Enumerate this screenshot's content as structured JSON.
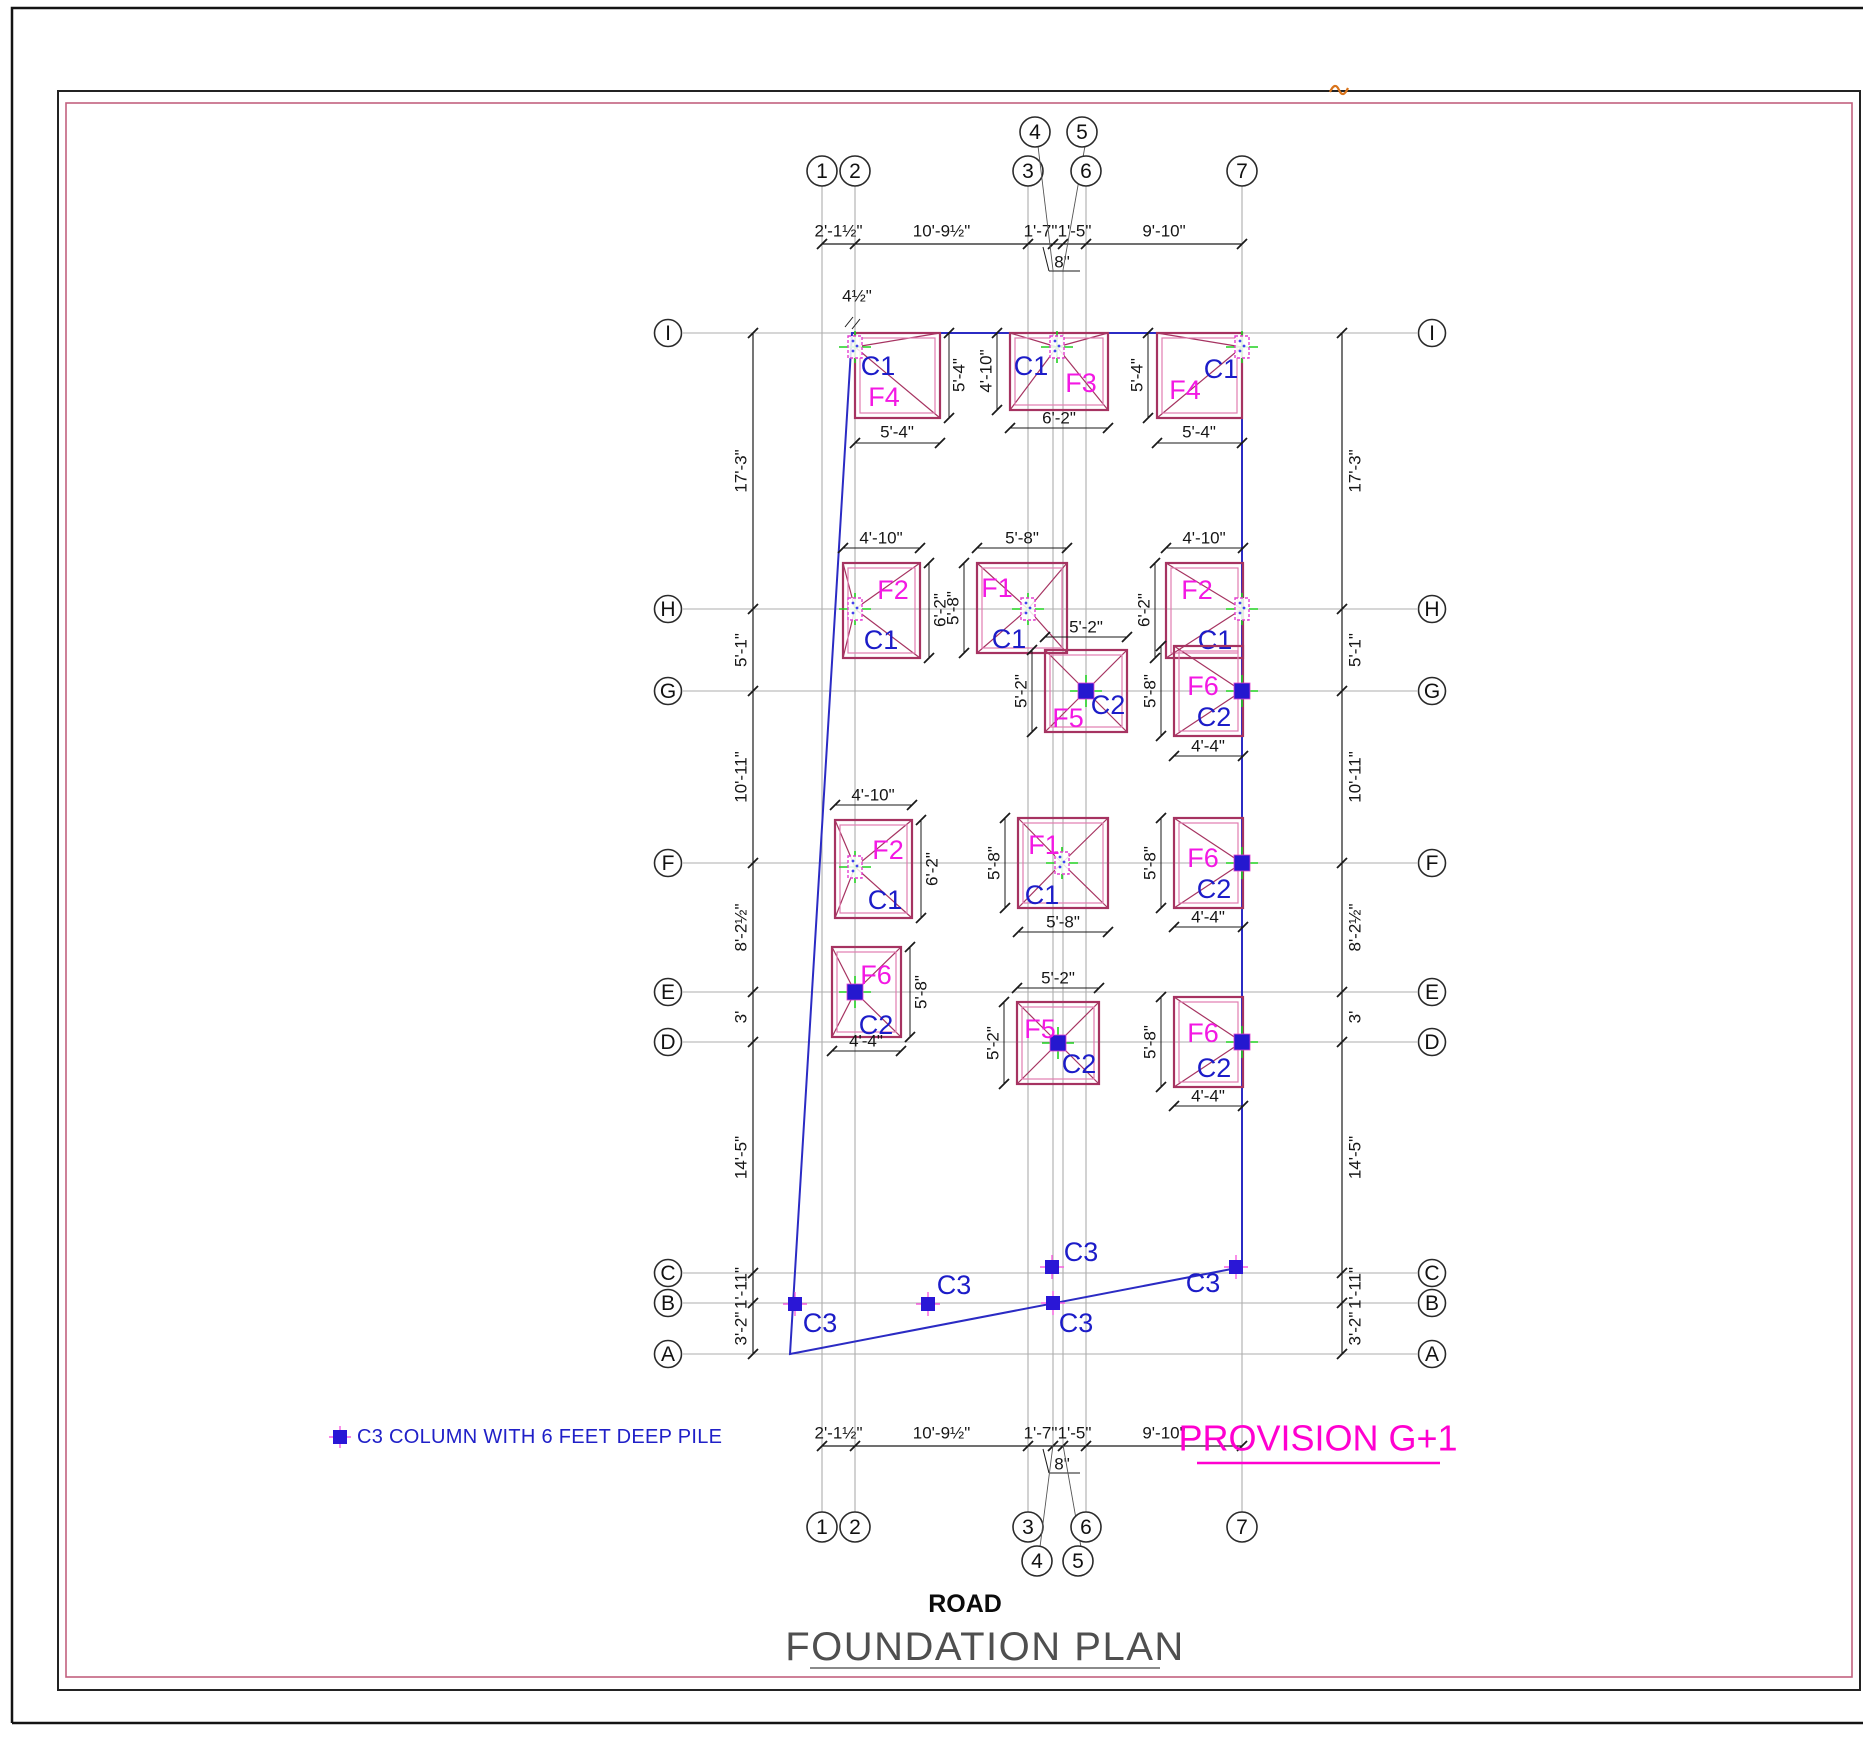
{
  "page": {
    "title_road": "ROAD",
    "title_plan": "FOUNDATION PLAN",
    "provision": "PROVISION G+1",
    "legend_text": "C3 COLUMN WITH 6 FEET DEEP PILE"
  },
  "colors": {
    "footing": "#A63361",
    "footing_inner": "#E17DB0",
    "grid": "#ADADAD",
    "dim": "#1A1A1A",
    "building_blue": "#2B2BC4",
    "label_c_blue": "#1C1CC8",
    "label_f_magenta": "#F318E3",
    "provision_magenta": "#FF00D0",
    "legend_blue": "#2020C8",
    "green_cross": "#21D121",
    "c2_fill": "#2518CF",
    "c3_fill": "#2A17D6",
    "c3_cross": "#F85FE0",
    "frame_pink": "#C2607E",
    "title_gray": "#4F4F4F",
    "orange": "#D9731A",
    "bubble_stroke": "#2A2A2A"
  },
  "grid": {
    "cols": [
      {
        "id": "1",
        "x": 822
      },
      {
        "id": "2",
        "x": 855
      },
      {
        "id": "3",
        "x": 1028
      },
      {
        "id": "4",
        "x": 1053,
        "short": true,
        "bt": [
          1035,
          132
        ],
        "bb": [
          1037,
          1561
        ]
      },
      {
        "id": "5",
        "x": 1063,
        "short": true,
        "bt": [
          1082,
          132
        ],
        "bb": [
          1078,
          1561
        ]
      },
      {
        "id": "6",
        "x": 1086
      },
      {
        "id": "7",
        "x": 1242
      }
    ],
    "rows": [
      {
        "id": "I",
        "y": 333
      },
      {
        "id": "H",
        "y": 609
      },
      {
        "id": "G",
        "y": 691
      },
      {
        "id": "F",
        "y": 863
      },
      {
        "id": "E",
        "y": 992
      },
      {
        "id": "D",
        "y": 1042
      },
      {
        "id": "C",
        "y": 1273
      },
      {
        "id": "B",
        "y": 1303
      },
      {
        "id": "A",
        "y": 1354
      }
    ],
    "col_line_y": [
      185,
      1512
    ],
    "col_line_y_short": [
      270,
      1445
    ],
    "row_line_x": [
      683,
      1417
    ],
    "top_bubble_y": 171,
    "bottom_bubble_y": 1527,
    "left_bubble_x": 668,
    "right_bubble_x": 1432
  },
  "dim_chains": [
    {
      "type": "v",
      "x": 753,
      "pts": [
        333,
        609,
        691,
        863,
        992,
        1042,
        1273,
        1303,
        1354
      ],
      "labels": [
        "17'-3\"",
        "5'-1\"",
        "10'-11\"",
        "8'-2½\"",
        "3'",
        "14'-5\"",
        "1'-11\"",
        "3'-2\""
      ],
      "side": -12
    },
    {
      "type": "v",
      "x": 1342,
      "pts": [
        333,
        609,
        691,
        863,
        992,
        1042,
        1273,
        1303,
        1354
      ],
      "labels": [
        "17'-3\"",
        "5'-1\"",
        "10'-11\"",
        "8'-2½\"",
        "3'",
        "14'-5\"",
        "1'-11\"",
        "3'-2\""
      ],
      "side": 13
    },
    {
      "type": "h",
      "y": 244,
      "pts": [
        822,
        855,
        1028,
        1053,
        1063,
        1086,
        1242
      ],
      "labels": [
        "2'-1½\"",
        "10'-9½\"",
        "1'-7\"",
        "",
        "1'-5\"",
        "9'-10\""
      ],
      "side": -13
    },
    {
      "type": "h",
      "y": 1446,
      "pts": [
        822,
        855,
        1028,
        1053,
        1063,
        1086,
        1242
      ],
      "labels": [
        "2'-1½\"",
        "10'-9½\"",
        "1'-7\"",
        "",
        "1'-5\"",
        "9'-10\""
      ],
      "side": -13
    }
  ],
  "annotations": [
    {
      "t": "8\"",
      "x": 1062,
      "y": 262,
      "lines": [
        [
          1043,
          247,
          1049,
          271
        ],
        [
          1049,
          271,
          1080,
          271
        ]
      ]
    },
    {
      "t": "8\"",
      "x": 1062,
      "y": 1464,
      "lines": [
        [
          1043,
          1449,
          1049,
          1473
        ],
        [
          1049,
          1473,
          1080,
          1473
        ]
      ]
    },
    {
      "t": "4½\"",
      "x": 857,
      "y": 296,
      "lines": [
        [
          845,
          327,
          853,
          317
        ],
        [
          852,
          329,
          860,
          319
        ]
      ]
    }
  ],
  "building_outline": [
    [
      852,
      333
    ],
    [
      1242,
      333
    ],
    [
      1242,
      1267
    ],
    [
      790,
      1354
    ]
  ],
  "footings": [
    {
      "n": "F4",
      "c": "C1",
      "r": [
        855,
        333,
        85,
        85
      ],
      "col": [
        855,
        347
      ],
      "ct": "C1",
      "fl": [
        884,
        397
      ],
      "cl": [
        878,
        366
      ],
      "dims": [
        {
          "x1": 949,
          "y1": 333,
          "x2": 949,
          "y2": 418,
          "t": "5'-4\"",
          "tx": 959,
          "ty": 375,
          "rot": 1
        },
        {
          "x1": 855,
          "y1": 443,
          "x2": 940,
          "y2": 443,
          "t": "5'-4\"",
          "tx": 897,
          "ty": 432,
          "rot": 0
        }
      ]
    },
    {
      "n": "F3",
      "c": "C1",
      "r": [
        1010,
        333,
        98,
        77
      ],
      "col": [
        1057,
        347
      ],
      "ct": "C1",
      "fl": [
        1081,
        383
      ],
      "cl": [
        1031,
        366
      ],
      "dims": [
        {
          "x1": 997,
          "y1": 333,
          "x2": 997,
          "y2": 410,
          "t": "4'-10\"",
          "tx": 986,
          "ty": 371,
          "rot": 1
        },
        {
          "x1": 1010,
          "y1": 428,
          "x2": 1108,
          "y2": 428,
          "t": "6'-2\"",
          "tx": 1059,
          "ty": 418,
          "rot": 0
        }
      ]
    },
    {
      "n": "F4",
      "c": "C1",
      "r": [
        1157,
        333,
        85,
        85
      ],
      "col": [
        1242,
        347
      ],
      "ct": "C1",
      "fl": [
        1185,
        390
      ],
      "cl": [
        1221,
        369
      ],
      "dims": [
        {
          "x1": 1148,
          "y1": 333,
          "x2": 1148,
          "y2": 418,
          "t": "5'-4\"",
          "tx": 1137,
          "ty": 375,
          "rot": 1
        },
        {
          "x1": 1157,
          "y1": 443,
          "x2": 1242,
          "y2": 443,
          "t": "5'-4\"",
          "tx": 1199,
          "ty": 432,
          "rot": 0
        }
      ]
    },
    {
      "n": "F2",
      "c": "C1",
      "r": [
        843,
        563,
        77,
        95
      ],
      "col": [
        855,
        609
      ],
      "ct": "C1",
      "fl": [
        893,
        590
      ],
      "cl": [
        881,
        640
      ],
      "dims": [
        {
          "x1": 843,
          "y1": 548,
          "x2": 920,
          "y2": 548,
          "t": "4'-10\"",
          "tx": 881,
          "ty": 538,
          "rot": 0
        },
        {
          "x1": 929,
          "y1": 563,
          "x2": 929,
          "y2": 658,
          "t": "6'-2\"",
          "tx": 940,
          "ty": 610,
          "rot": 1
        }
      ]
    },
    {
      "n": "F1",
      "c": "C1",
      "r": [
        977,
        563,
        90,
        90
      ],
      "col": [
        1028,
        609
      ],
      "ct": "C1",
      "fl": [
        997,
        588
      ],
      "cl": [
        1009,
        639
      ],
      "dims": [
        {
          "x1": 977,
          "y1": 548,
          "x2": 1067,
          "y2": 548,
          "t": "5'-8\"",
          "tx": 1022,
          "ty": 538,
          "rot": 0
        },
        {
          "x1": 964,
          "y1": 563,
          "x2": 964,
          "y2": 653,
          "t": "5'-8\"",
          "tx": 953,
          "ty": 608,
          "rot": 1
        }
      ]
    },
    {
      "n": "F2",
      "c": "C1",
      "r": [
        1166,
        563,
        77,
        95
      ],
      "col": [
        1242,
        609
      ],
      "ct": "C1",
      "fl": [
        1197,
        590
      ],
      "cl": [
        1215,
        640
      ],
      "dims": [
        {
          "x1": 1166,
          "y1": 548,
          "x2": 1243,
          "y2": 548,
          "t": "4'-10\"",
          "tx": 1204,
          "ty": 538,
          "rot": 0
        },
        {
          "x1": 1155,
          "y1": 563,
          "x2": 1155,
          "y2": 658,
          "t": "6'-2\"",
          "tx": 1144,
          "ty": 610,
          "rot": 1
        }
      ]
    },
    {
      "n": "F5",
      "c": "C2",
      "r": [
        1045,
        650,
        82,
        82
      ],
      "col": [
        1086,
        691
      ],
      "ct": "C2",
      "fl": [
        1068,
        718
      ],
      "cl": [
        1108,
        705
      ],
      "dims": [
        {
          "x1": 1045,
          "y1": 637,
          "x2": 1127,
          "y2": 637,
          "t": "5'-2\"",
          "tx": 1086,
          "ty": 627,
          "rot": 0
        },
        {
          "x1": 1032,
          "y1": 650,
          "x2": 1032,
          "y2": 732,
          "t": "5'-2\"",
          "tx": 1021,
          "ty": 691,
          "rot": 1
        }
      ]
    },
    {
      "n": "F6",
      "c": "C2",
      "r": [
        1174,
        646,
        69,
        90
      ],
      "col": [
        1242,
        691
      ],
      "ct": "C2",
      "fl": [
        1203,
        686
      ],
      "cl": [
        1214,
        717
      ],
      "dims": [
        {
          "x1": 1161,
          "y1": 646,
          "x2": 1161,
          "y2": 736,
          "t": "5'-8\"",
          "tx": 1150,
          "ty": 691,
          "rot": 1
        },
        {
          "x1": 1174,
          "y1": 756,
          "x2": 1243,
          "y2": 756,
          "t": "4'-4\"",
          "tx": 1208,
          "ty": 746,
          "rot": 0
        }
      ]
    },
    {
      "n": "F2",
      "c": "C1",
      "r": [
        835,
        820,
        77,
        98
      ],
      "col": [
        855,
        867
      ],
      "ct": "C1",
      "fl": [
        888,
        850
      ],
      "cl": [
        885,
        900
      ],
      "dims": [
        {
          "x1": 835,
          "y1": 805,
          "x2": 912,
          "y2": 805,
          "t": "4'-10\"",
          "tx": 873,
          "ty": 795,
          "rot": 0
        },
        {
          "x1": 921,
          "y1": 820,
          "x2": 921,
          "y2": 918,
          "t": "6'-2\"",
          "tx": 932,
          "ty": 869,
          "rot": 1
        }
      ]
    },
    {
      "n": "F1",
      "c": "C1",
      "r": [
        1018,
        818,
        90,
        90
      ],
      "col": [
        1062,
        863
      ],
      "ct": "C1",
      "fl": [
        1044,
        845
      ],
      "cl": [
        1042,
        895
      ],
      "dims": [
        {
          "x1": 1005,
          "y1": 818,
          "x2": 1005,
          "y2": 908,
          "t": "5'-8\"",
          "tx": 994,
          "ty": 863,
          "rot": 1
        },
        {
          "x1": 1018,
          "y1": 932,
          "x2": 1108,
          "y2": 932,
          "t": "5'-8\"",
          "tx": 1063,
          "ty": 922,
          "rot": 0
        }
      ]
    },
    {
      "n": "F6",
      "c": "C2",
      "r": [
        1174,
        818,
        69,
        90
      ],
      "col": [
        1242,
        863
      ],
      "ct": "C2",
      "fl": [
        1203,
        858
      ],
      "cl": [
        1214,
        889
      ],
      "dims": [
        {
          "x1": 1161,
          "y1": 818,
          "x2": 1161,
          "y2": 908,
          "t": "5'-8\"",
          "tx": 1150,
          "ty": 863,
          "rot": 1
        },
        {
          "x1": 1174,
          "y1": 927,
          "x2": 1243,
          "y2": 927,
          "t": "4'-4\"",
          "tx": 1208,
          "ty": 917,
          "rot": 0
        }
      ]
    },
    {
      "n": "F6",
      "c": "C2",
      "r": [
        832,
        947,
        69,
        90
      ],
      "col": [
        855,
        992
      ],
      "ct": "C2",
      "fl": [
        876,
        975
      ],
      "cl": [
        876,
        1025
      ],
      "dims": [
        {
          "x1": 910,
          "y1": 947,
          "x2": 910,
          "y2": 1037,
          "t": "5'-8\"",
          "tx": 921,
          "ty": 992,
          "rot": 1
        },
        {
          "x1": 832,
          "y1": 1051,
          "x2": 901,
          "y2": 1051,
          "t": "4'-4\"",
          "tx": 866,
          "ty": 1041,
          "rot": 0
        }
      ]
    },
    {
      "n": "F5",
      "c": "C2",
      "r": [
        1017,
        1002,
        82,
        82
      ],
      "col": [
        1058,
        1043
      ],
      "ct": "C2",
      "fl": [
        1040,
        1029
      ],
      "cl": [
        1079,
        1064
      ],
      "dims": [
        {
          "x1": 1017,
          "y1": 988,
          "x2": 1099,
          "y2": 988,
          "t": "5'-2\"",
          "tx": 1058,
          "ty": 978,
          "rot": 0
        },
        {
          "x1": 1004,
          "y1": 1002,
          "x2": 1004,
          "y2": 1084,
          "t": "5'-2\"",
          "tx": 993,
          "ty": 1043,
          "rot": 1
        }
      ]
    },
    {
      "n": "F6",
      "c": "C2",
      "r": [
        1174,
        997,
        69,
        90
      ],
      "col": [
        1242,
        1042
      ],
      "ct": "C2",
      "fl": [
        1203,
        1033
      ],
      "cl": [
        1214,
        1068
      ],
      "dims": [
        {
          "x1": 1161,
          "y1": 997,
          "x2": 1161,
          "y2": 1087,
          "t": "5'-8\"",
          "tx": 1150,
          "ty": 1042,
          "rot": 1
        },
        {
          "x1": 1174,
          "y1": 1106,
          "x2": 1243,
          "y2": 1106,
          "t": "4'-4\"",
          "tx": 1208,
          "ty": 1096,
          "rot": 0
        }
      ]
    }
  ],
  "c3_columns": [
    {
      "cx": 795,
      "cy": 1304,
      "lx": 820,
      "ly": 1323,
      "label": "C3"
    },
    {
      "cx": 928,
      "cy": 1304,
      "lx": 954,
      "ly": 1285,
      "label": "C3"
    },
    {
      "cx": 1052,
      "cy": 1267,
      "lx": 1081,
      "ly": 1252,
      "label": "C3"
    },
    {
      "cx": 1053,
      "cy": 1303,
      "lx": 1076,
      "ly": 1323,
      "label": "C3"
    },
    {
      "cx": 1236,
      "cy": 1267,
      "lx": 1203,
      "ly": 1283,
      "label": "C3"
    }
  ]
}
